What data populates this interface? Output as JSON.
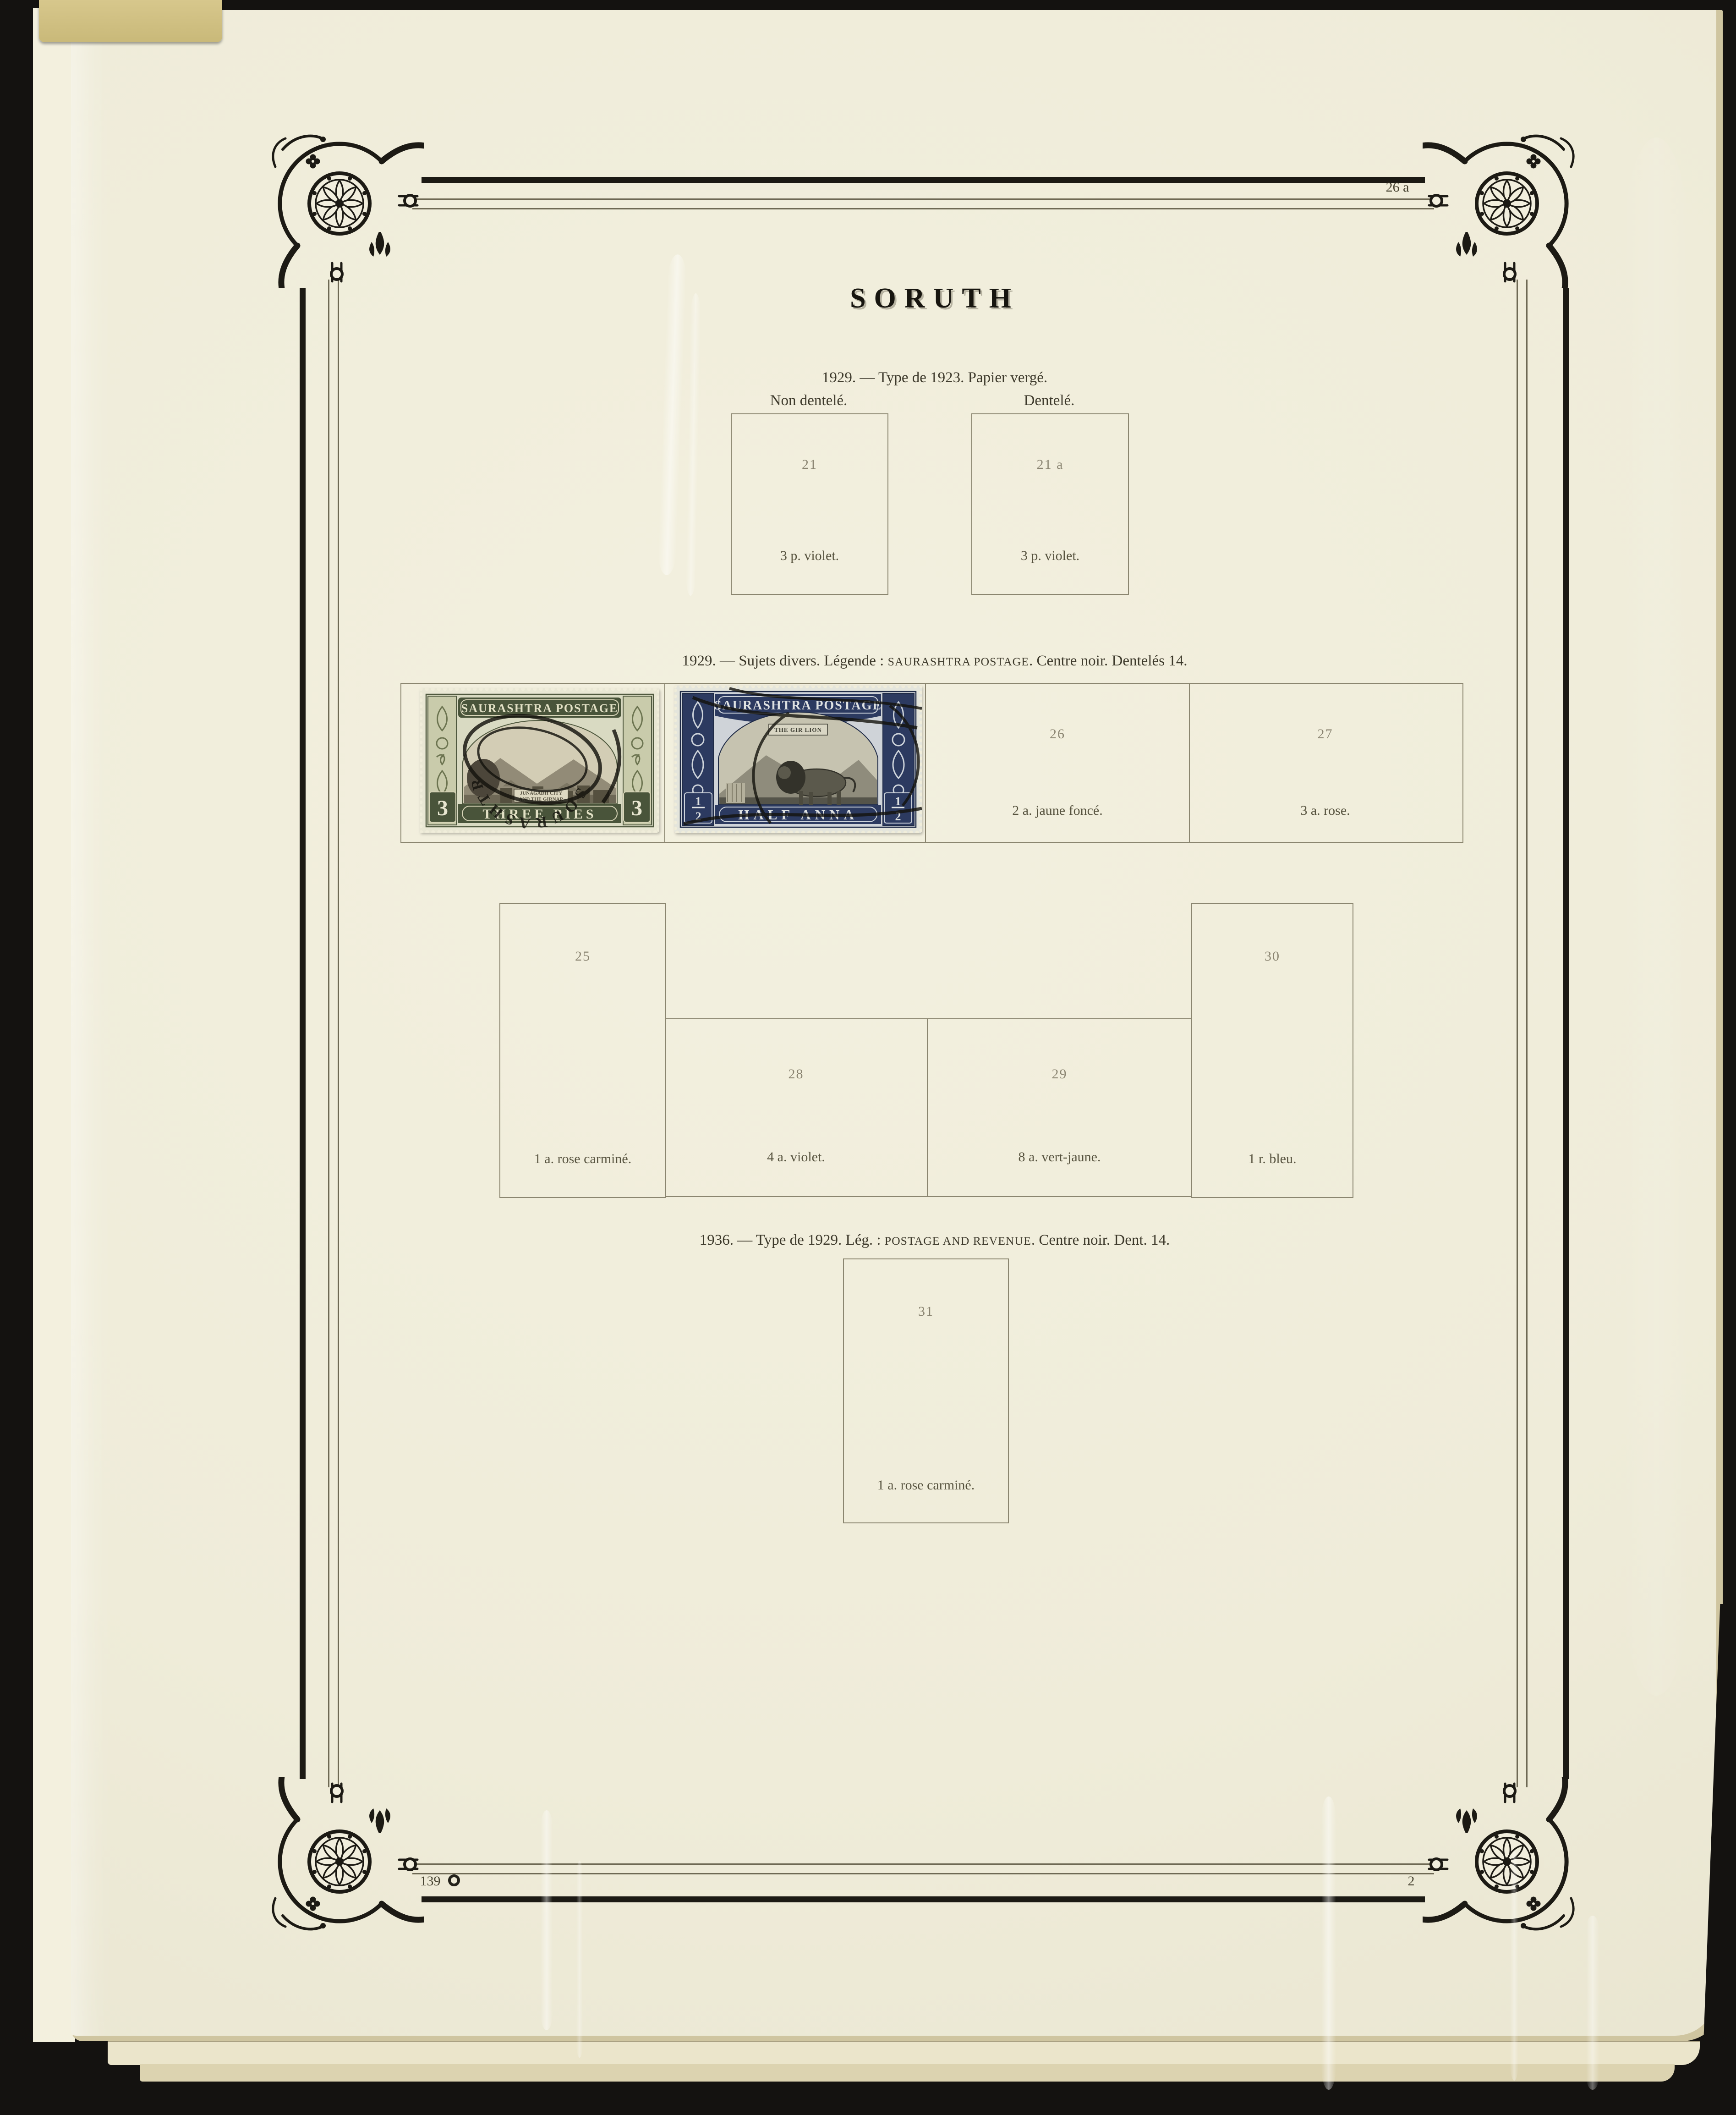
{
  "title": "SORUTH",
  "refs": {
    "plate": "26 a",
    "page_left": "139",
    "page_right": "2"
  },
  "s1": {
    "heading": "1929. — Type de 1923. Papier vergé.",
    "left_label": "Non dentelé.",
    "right_label": "Dentelé.",
    "b21": {
      "n": "21",
      "c": "3 p. violet."
    },
    "b21a": {
      "n": "21 a",
      "c": "3 p. violet."
    }
  },
  "s2": {
    "h_pre": "1929. — Sujets divers. Légende : ",
    "h_caps": "SAURASHTRA POSTAGE",
    "h_post": ". Centre noir. Dentelés 14.",
    "b26": {
      "n": "26",
      "c": "2 a. jaune foncé."
    },
    "b27": {
      "n": "27",
      "c": "3 a. rose."
    },
    "b25": {
      "n": "25",
      "c": "1 a. rose carminé."
    },
    "b28": {
      "n": "28",
      "c": "4 a. violet."
    },
    "b29": {
      "n": "29",
      "c": "8 a. vert-jaune."
    },
    "b30": {
      "n": "30",
      "c": "1 r. bleu."
    }
  },
  "s3": {
    "h_pre": "1936. — Type de 1929. Lég. : ",
    "h_caps": "POSTAGE AND REVENUE",
    "h_post": ". Centre noir. Dent. 14.",
    "b31": {
      "n": "31",
      "c": "1 a. rose carminé."
    }
  },
  "stamp_green": {
    "country": "SAURASHTRA POSTAGE",
    "vignette1": "JUNAGADH CITY",
    "vignette2": "AND THE GIRNAR",
    "denom": "THREE PIES",
    "value": "3",
    "postmark": "SOURASHTRA",
    "frame_color": "#5d6845"
  },
  "stamp_blue": {
    "country": "SAURASHTRA POSTAGE",
    "vignette_label": "THE GIR LION",
    "denom": "HALF ANNA",
    "value_num": "1",
    "value_den": "2",
    "frame_color": "#2c3a60"
  },
  "colors": {
    "paper": "#f0edda",
    "ink": "#1c1a14",
    "caption_ink": "#57533f",
    "number_ink": "#8a8471",
    "background": "#141210"
  }
}
